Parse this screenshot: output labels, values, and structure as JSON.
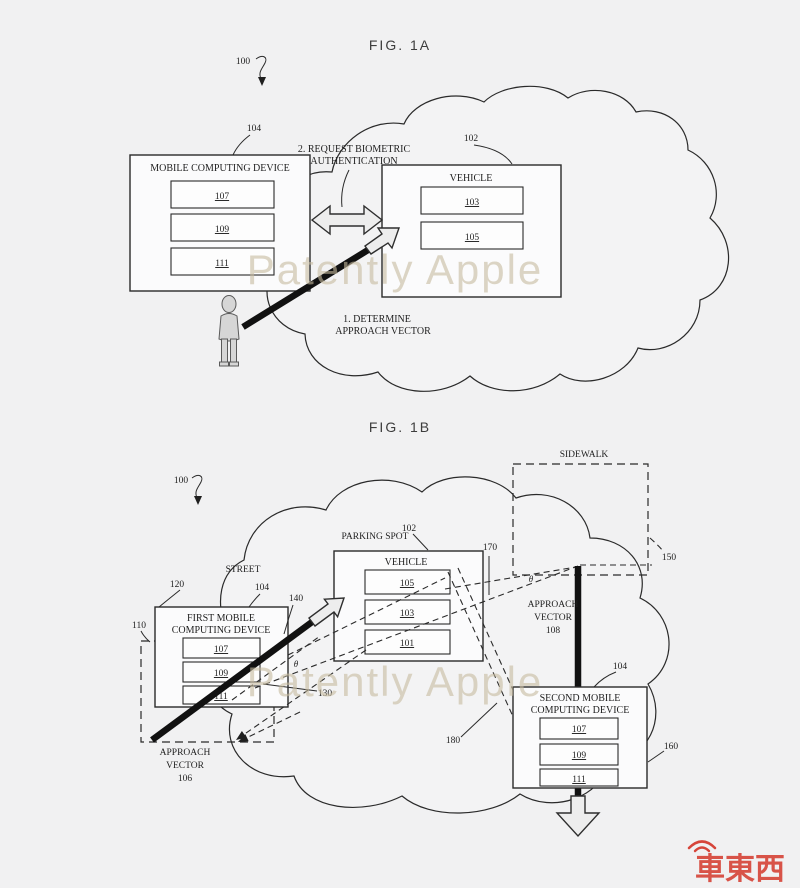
{
  "page": {
    "background": "#f1f1f2",
    "line_color": "#2a2a2a"
  },
  "watermark": {
    "text": "Patently Apple",
    "color": "#c6bb9e",
    "logo_text": "車東西",
    "logo_color": "#d6453a"
  },
  "fig1a": {
    "title": "FIG. 1A",
    "ref_100": "100",
    "mobile_device": {
      "ref": "104",
      "title": "MOBILE COMPUTING DEVICE",
      "components": [
        "107",
        "109",
        "111"
      ]
    },
    "vehicle": {
      "ref": "102",
      "title": "VEHICLE",
      "components": [
        "103",
        "105"
      ]
    },
    "step2_line1": "2. REQUEST BIOMETRIC",
    "step2_line2": "AUTHENTICATION",
    "step1_line1": "1. DETERMINE",
    "step1_line2": "APPROACH VECTOR"
  },
  "fig1b": {
    "title": "FIG. 1B",
    "ref_100": "100",
    "sidewalk": {
      "label": "SIDEWALK",
      "ref": "150"
    },
    "street": "STREET",
    "parking_spot": {
      "label": "PARKING SPOT",
      "ref": "102"
    },
    "vehicle": {
      "title": "VEHICLE",
      "components": [
        "105",
        "103",
        "101"
      ]
    },
    "ref_170": "170",
    "theta": "θ",
    "approach_vector_108": {
      "line1": "APPROACH",
      "line2": "VECTOR",
      "ref": "108"
    },
    "first_device": {
      "ref_120": "120",
      "ref_104": "104",
      "ref_110": "110",
      "title_line1": "FIRST MOBILE",
      "title_line2": "COMPUTING DEVICE",
      "components": [
        "107",
        "109",
        "111"
      ]
    },
    "ref_140": "140",
    "ref_130": "130",
    "approach_vector_106": {
      "line1": "APPROACH",
      "line2": "VECTOR",
      "ref": "106"
    },
    "ref_180": "180",
    "second_device": {
      "ref_104": "104",
      "ref_160": "160",
      "title_line1": "SECOND MOBILE",
      "title_line2": "COMPUTING DEVICE",
      "components": [
        "107",
        "109",
        "111"
      ]
    }
  }
}
